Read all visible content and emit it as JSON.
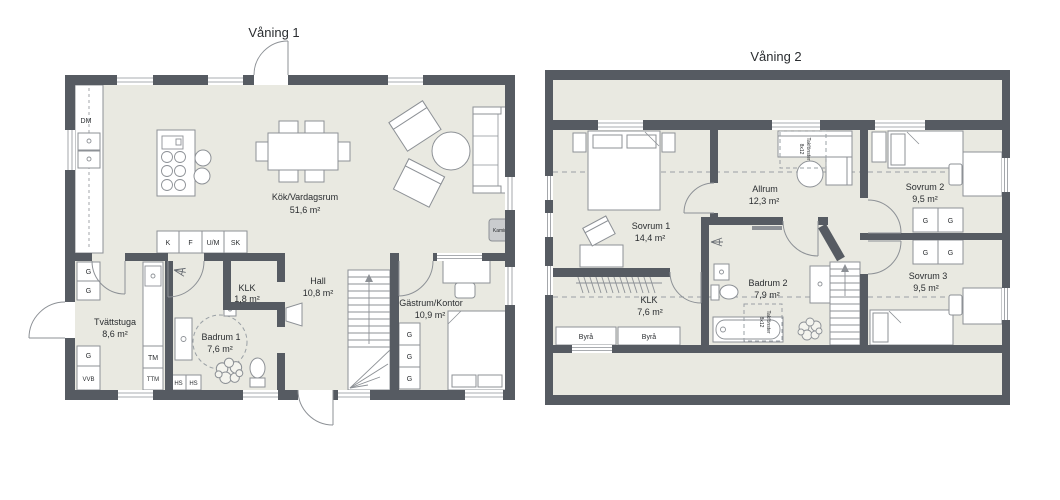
{
  "titles": {
    "floor1": "Våning 1",
    "floor2": "Våning 2"
  },
  "floor1": {
    "rooms": {
      "kok": {
        "name": "Kök/Vardagsrum",
        "area": "51,6 m²"
      },
      "hall": {
        "name": "Hall",
        "area": "10,8 m²"
      },
      "klk": {
        "name": "KLK",
        "area": "1,8 m²"
      },
      "gastrum": {
        "name": "Gästrum/Kontor",
        "area": "10,9 m²"
      },
      "tvattstuga": {
        "name": "Tvättstuga",
        "area": "8,6 m²"
      },
      "badrum": {
        "name": "Badrum 1",
        "area": "7,6 m²"
      }
    },
    "labels": {
      "dm": "DM",
      "k": "K",
      "f": "F",
      "um": "U/M",
      "sk": "SK",
      "g": "G",
      "vvb": "VVB",
      "tm": "TM",
      "ttm": "TTM",
      "hs": "HS",
      "kamin": "Kamin"
    }
  },
  "floor2": {
    "rooms": {
      "sovrum1": {
        "name": "Sovrum 1",
        "area": "14,4 m²"
      },
      "allrum": {
        "name": "Allrum",
        "area": "12,3 m²"
      },
      "sovrum2": {
        "name": "Sovrum 2",
        "area": "9,5 m²"
      },
      "sovrum3": {
        "name": "Sovrum 3",
        "area": "9,5 m²"
      },
      "badrum2": {
        "name": "Badrum 2",
        "area": "7,9 m²"
      },
      "klk": {
        "name": "KLK",
        "area": "7,6 m²"
      }
    },
    "labels": {
      "byra": "Byrå",
      "g": "G",
      "takfonster": "Takfönster",
      "takfonster_size": "8x12"
    }
  },
  "colors": {
    "wall": "#565b62",
    "floor": "#e9e9e1",
    "line": "#8d9196",
    "text": "#2a2d30"
  }
}
